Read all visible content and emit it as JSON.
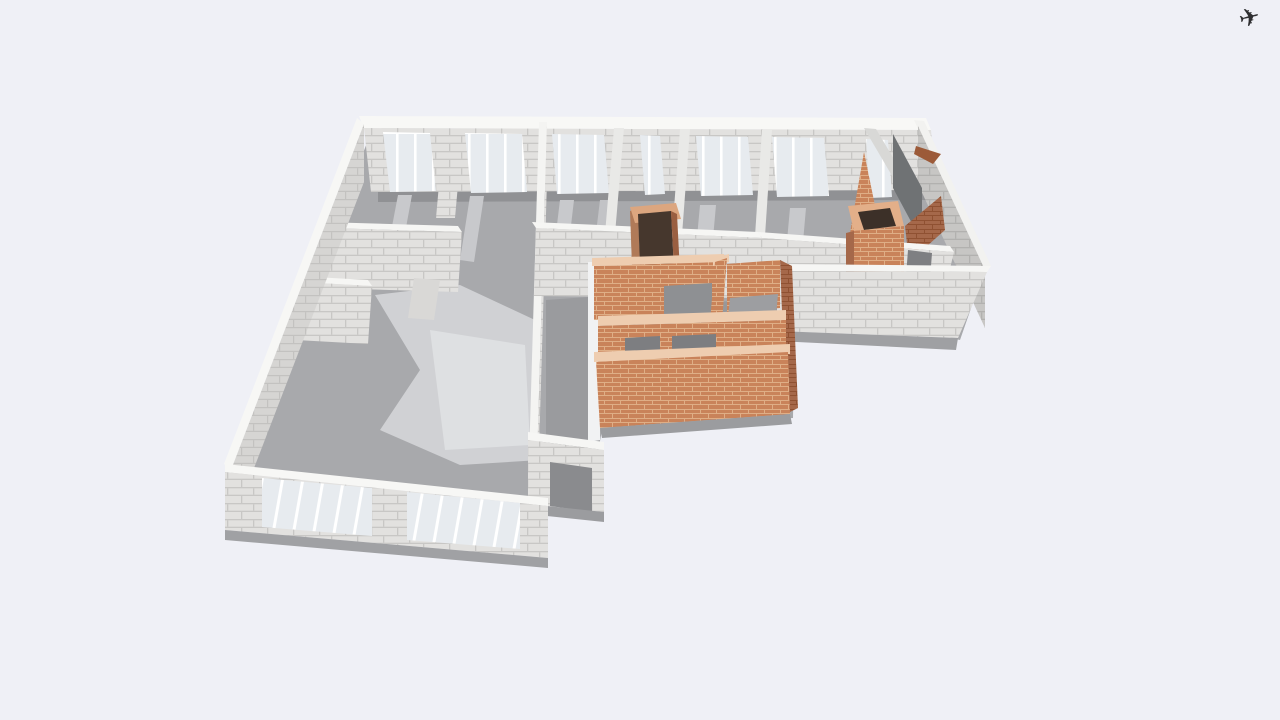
{
  "app": {
    "background": "#eff0f6"
  },
  "toolbar": {
    "airplane_icon": "✈"
  },
  "materials": {
    "concrete": {
      "base": "#e2e1df",
      "line": "#c8c7c5"
    },
    "concreteShade": {
      "base": "#c7c6c4",
      "line": "#b2b1af"
    },
    "concreteLight": {
      "base": "#d6d5d3",
      "line": "#c3c2c0"
    },
    "brick": {
      "base": "#c9835a",
      "line": "#dfae86"
    },
    "brickShade": {
      "base": "#a5684a",
      "line": "#8f5132"
    },
    "window": {
      "base": "#e7ebef",
      "stripe": "#ffffff"
    }
  },
  "scene": {
    "polygons": [
      {
        "name": "floor-slab",
        "points": "370,135 915,133 985,268 960,340 795,300 793,418 602,430 598,452 545,505 242,466",
        "fill": "#a8a9ac"
      },
      {
        "name": "floor-light-left-wing",
        "points": "375,295 460,285 535,320 540,460 460,465 380,430 420,370",
        "fill": "#d0d1d4"
      },
      {
        "name": "floor-bright-left-wing",
        "points": "430,330 525,345 530,445 445,450",
        "fill": "#dee0e2"
      },
      {
        "name": "floor-shadow-back-wall",
        "points": "378,188 932,186 932,200 378,202",
        "fill": "#909194"
      },
      {
        "name": "floor-light-stripe",
        "points": "398,195 412,195 400,260 386,258",
        "fill": "#c8c9cc"
      },
      {
        "name": "floor-light-stripe",
        "points": "470,196 484,196 474,262 460,260",
        "fill": "#c8c9cc"
      },
      {
        "name": "floor-light-stripe",
        "points": "560,200 574,200 566,268 552,266",
        "fill": "#c8c9cc"
      },
      {
        "name": "floor-light-stripe",
        "points": "600,200 612,200 604,268 592,266",
        "fill": "#c2c3c6"
      },
      {
        "name": "floor-light-stripe",
        "points": "700,205 716,205 710,272 694,270",
        "fill": "#c8c9cc"
      },
      {
        "name": "floor-light-stripe",
        "points": "790,208 806,208 800,276 784,274",
        "fill": "#c8c9cc"
      },
      {
        "name": "floor-light-stripe",
        "points": "886,216 900,218 906,276 892,274",
        "fill": "#c2c3c6"
      },
      {
        "name": "floor-dark-corridor",
        "points": "548,300 795,302 795,360 548,368",
        "fill": "#97989b"
      },
      {
        "name": "floor-dark-center-front",
        "points": "546,300 588,297 588,450 546,456",
        "fill": "#9a9b9e"
      },
      {
        "name": "back-wall-top",
        "points": "359,116 926,118 931,130 364,128",
        "fill": "#f8f8f6"
      },
      {
        "name": "back-wall-face",
        "points": "364,128 931,130 936,190 371,192",
        "fill": "url(#pblock)"
      },
      {
        "name": "back-window",
        "points": "383,132 430,133 436,191 390,192",
        "fill": "url(#pwin)"
      },
      {
        "name": "back-window",
        "points": "465,133 522,134 527,192 471,193",
        "fill": "url(#pwin)"
      },
      {
        "name": "back-window",
        "points": "552,134 604,135 609,193 557,194",
        "fill": "url(#pwin)"
      },
      {
        "name": "back-window",
        "points": "640,135 660,136 665,194 645,195",
        "fill": "url(#pwin)"
      },
      {
        "name": "back-window",
        "points": "696,136 748,137 753,195 701,196",
        "fill": "url(#pwin)"
      },
      {
        "name": "back-window",
        "points": "772,137 824,138 829,196 777,197",
        "fill": "url(#pwin)"
      },
      {
        "name": "back-window",
        "points": "866,139 888,140 892,197 870,198",
        "fill": "url(#pwin)"
      },
      {
        "name": "wall-stub-top-band",
        "points": "443,140 462,140 455,218 436,218",
        "fill": "url(#pblock)"
      },
      {
        "name": "left-wing-east-wall-top",
        "points": "539,122 547,122 537,460 529,460",
        "fill": "#f4f4f2"
      },
      {
        "name": "left-wing-east-wall-face",
        "points": "547,124 537,462 537,518 547,180",
        "fill": "url(#pblock)"
      },
      {
        "name": "room-partition",
        "points": "614,128 624,128 615,234 605,234",
        "fill": "#e9e9e7"
      },
      {
        "name": "room-partition",
        "points": "680,129 690,129 682,235 672,235",
        "fill": "#e9e9e7"
      },
      {
        "name": "room-partition",
        "points": "762,130 772,130 765,236 755,236",
        "fill": "#e9e9e7"
      },
      {
        "name": "room-partition-right",
        "points": "864,128 876,129 910,186 898,186",
        "fill": "#d8d8d6"
      },
      {
        "name": "right-wall-top",
        "points": "914,120 924,121 991,266 981,266",
        "fill": "#f2f2f0"
      },
      {
        "name": "right-wall-face",
        "points": "918,126 985,270 985,328 918,184",
        "fill": "url(#pblockShade)"
      },
      {
        "name": "stair-dark-wall",
        "points": "893,134 922,188 922,242 893,188",
        "fill": "#6f7274"
      },
      {
        "name": "stair-brick-slope-tall",
        "points": "850,233 864,152 880,230",
        "fill": "url(#pbrick)"
      },
      {
        "name": "stair-brick-bit",
        "points": "916,146 941,154 933,164 914,154",
        "fill": "#9c5a38"
      },
      {
        "name": "stair-brick-slope-low",
        "points": "905,226 941,196 945,230 909,262",
        "fill": "url(#pbrickShade)"
      },
      {
        "name": "mid-wall-left-top",
        "points": "322,222 458,226 462,232 326,228",
        "fill": "#f6f6f4"
      },
      {
        "name": "mid-wall-left-face",
        "points": "326,228 462,232 458,292 322,288",
        "fill": "url(#pblock)"
      },
      {
        "name": "mid-wall-center-top",
        "points": "532,222 758,232 762,238 536,228",
        "fill": "#f6f6f4"
      },
      {
        "name": "mid-wall-center-face",
        "points": "536,228 762,238 760,298 534,296",
        "fill": "url(#pblock)"
      },
      {
        "name": "mid-wall-right-top",
        "points": "758,232 950,246 954,252 762,238",
        "fill": "#f6f6f4"
      },
      {
        "name": "mid-wall-right-face",
        "points": "762,238 954,252 940,310 760,298",
        "fill": "url(#pblock)"
      },
      {
        "name": "doorway-right-dark",
        "points": "908,250 932,253 928,306 904,302",
        "fill": "#7e7f82"
      },
      {
        "name": "chimney-center-left-side",
        "points": "630,211 638,208 641,291 633,294",
        "fill": "#b07a58"
      },
      {
        "name": "chimney-center-rim",
        "points": "630,207 676,203 681,219 635,223",
        "fill": "#dca67f"
      },
      {
        "name": "chimney-center-hollow",
        "points": "638,214 671,211 675,288 641,291",
        "fill": "#46372d"
      },
      {
        "name": "chimney-center-right-side",
        "points": "671,211 677,214 681,292 675,289",
        "fill": "#9a5f41"
      },
      {
        "name": "left-wing-mid2-wall-top",
        "points": "296,276 368,280 372,286 300,282",
        "fill": "#f6f6f4"
      },
      {
        "name": "left-wing-mid2-wall-face",
        "points": "300,282 372,286 368,344 296,340",
        "fill": "url(#pblock)"
      },
      {
        "name": "left-wing-wall-stub",
        "points": "414,278 440,280 434,320 408,318",
        "fill": "#d9d8d6"
      },
      {
        "name": "chimney-right-rim",
        "points": "848,206 898,201 904,226 854,231",
        "fill": "#e3af89"
      },
      {
        "name": "chimney-right-hollow",
        "points": "858,212 890,208 896,226 864,230",
        "fill": "#3c3028"
      },
      {
        "name": "chimney-right-face",
        "points": "854,231 904,226 904,298 854,303",
        "fill": "url(#pbrick)"
      },
      {
        "name": "chimney-right-west-side",
        "points": "846,233 854,231 854,303 846,305",
        "fill": "#a5684a"
      },
      {
        "name": "front-right-wall-top",
        "points": "777,264 991,266 987,272 777,271",
        "fill": "#f6f6f4"
      },
      {
        "name": "front-right-wall-face",
        "points": "777,271 987,272 958,338 777,331",
        "fill": "url(#pblock)"
      },
      {
        "name": "front-right-wall-shadow",
        "points": "777,331 958,338 956,350 777,341",
        "fill": "#9fa0a3"
      },
      {
        "name": "brick-room-west-wall",
        "points": "588,262 600,262 600,440 588,442",
        "fill": "#f1f2f3"
      },
      {
        "name": "brick-room-north-wall-top",
        "points": "592,258 724,254 724,262 592,266",
        "fill": "#eecdb0"
      },
      {
        "name": "brick-room-north-wall-face",
        "points": "594,266 722,262 722,316 594,320",
        "fill": "url(#pbrick)"
      },
      {
        "name": "brick-room-north-opening",
        "points": "664,286 712,283 712,316 664,319",
        "fill": "#8e9093"
      },
      {
        "name": "brick-room-partition-top",
        "points": "713,258 729,254 729,262 713,266",
        "fill": "#eecdb0"
      },
      {
        "name": "brick-room-partition-face",
        "points": "715,262 727,258 719,360 707,358",
        "fill": "url(#pbrick)"
      },
      {
        "name": "brick-room-ne-wall-face",
        "points": "727,264 780,260 780,308 727,312",
        "fill": "url(#pbrick)"
      },
      {
        "name": "brick-room-ne-floor",
        "points": "730,298 778,294 776,316 728,318",
        "fill": "#9d9ea1"
      },
      {
        "name": "brick-room-east-edge",
        "points": "780,260 792,266 798,408 786,414",
        "fill": "url(#pbrickShade)"
      },
      {
        "name": "brick-room-mid-wall-top",
        "points": "598,316 786,310 786,320 598,326",
        "fill": "#eecdb0"
      },
      {
        "name": "brick-room-mid-wall-face",
        "points": "598,326 786,320 786,364 598,370",
        "fill": "url(#pbrick)"
      },
      {
        "name": "brick-room-doorway",
        "points": "625,338 660,336 660,368 625,370",
        "fill": "#7d7e81"
      },
      {
        "name": "brick-room-doorway",
        "points": "672,336 716,334 716,364 672,366",
        "fill": "#7d7e81"
      },
      {
        "name": "brick-room-south-wall-top",
        "points": "594,352 790,344 790,354 594,362",
        "fill": "#eecdb0"
      },
      {
        "name": "brick-room-south-wall-face",
        "points": "596,362 788,352 790,414 600,428",
        "fill": "url(#pbrick)"
      },
      {
        "name": "brick-room-ground-shadow",
        "points": "600,428 790,414 792,424 602,438",
        "fill": "#9b9c9f"
      },
      {
        "name": "center-front-wall-top",
        "points": "528,432 604,442 604,450 528,440",
        "fill": "#f6f6f4"
      },
      {
        "name": "center-front-wall-face",
        "points": "528,440 604,450 604,512 528,504",
        "fill": "url(#pblock)"
      },
      {
        "name": "center-front-doorway",
        "points": "550,462 592,468 592,512 550,506",
        "fill": "#8a8b8e"
      },
      {
        "name": "center-front-ground-shadow",
        "points": "528,504 604,512 604,522 528,514",
        "fill": "#9b9c9f"
      },
      {
        "name": "west-wall-top",
        "points": "357,118 364,124 231,470 224,464",
        "fill": "#f7f7f5"
      },
      {
        "name": "west-wall-face",
        "points": "364,124 231,470 231,528 364,182",
        "fill": "url(#pblockL)"
      },
      {
        "name": "front-wall-top",
        "points": "225,464 548,498 548,506 225,472",
        "fill": "#f7f7f5"
      },
      {
        "name": "front-wall-face",
        "points": "225,472 548,506 548,558 225,530",
        "fill": "url(#pblock)"
      },
      {
        "name": "front-window",
        "points": "262,478 372,488 372,536 262,527",
        "fill": "url(#pwinF)"
      },
      {
        "name": "front-window",
        "points": "407,492 520,503 520,549 407,540",
        "fill": "url(#pwinF)"
      },
      {
        "name": "front-wall-ground-shadow",
        "points": "225,530 548,558 548,568 225,540",
        "fill": "#a0a1a4"
      }
    ]
  }
}
